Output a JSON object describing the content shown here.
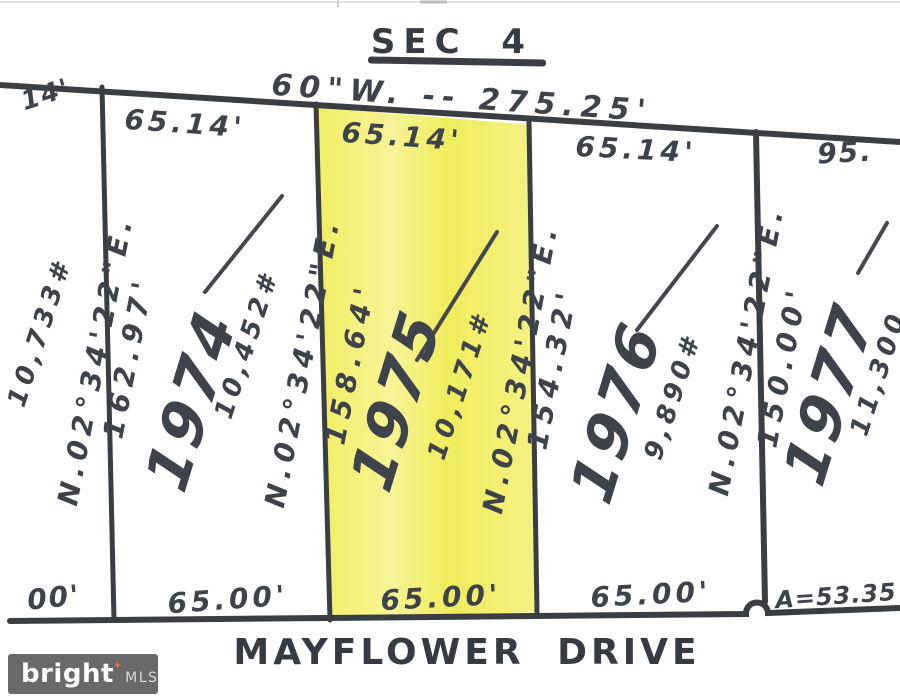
{
  "title": {
    "section": "SEC 4"
  },
  "street": {
    "name": "MAYFLOWER DRIVE"
  },
  "north_edge": {
    "bearing_dim": "60\"W. -- 275.25'",
    "left_cut": "14'",
    "right_cut": "95."
  },
  "south_edge": {
    "left_cut": "00'",
    "arc": "A=53.35"
  },
  "partial_lot_left": {
    "area": "10,733#"
  },
  "lots": [
    {
      "number": "1974",
      "area": "10,452#",
      "rear": "65.14'",
      "front": "65.00'",
      "west_bearing": "N.02°34'22\"E.",
      "west_length": "162.97'",
      "highlighted": false
    },
    {
      "number": "1975",
      "area": "10,171#",
      "rear": "65.14'",
      "front": "65.00'",
      "west_bearing": "N.02°34'22\"E.",
      "west_length": "158.64'",
      "highlighted": true
    },
    {
      "number": "1976",
      "area": "9,890#",
      "rear": "65.14'",
      "front": "65.00'",
      "west_bearing": "N.02°34'22\"E.",
      "west_length": "154.32'",
      "highlighted": false
    },
    {
      "number": "1977",
      "area": "11,300",
      "west_bearing": "N.02°34'22\"E.",
      "west_length": "150.00'",
      "highlighted": false
    }
  ],
  "watermark": {
    "brand": "bright",
    "spark": "✦",
    "org": "MLS"
  },
  "colors": {
    "highlight": "#f1ed5f",
    "ink": "#3a3e43"
  }
}
